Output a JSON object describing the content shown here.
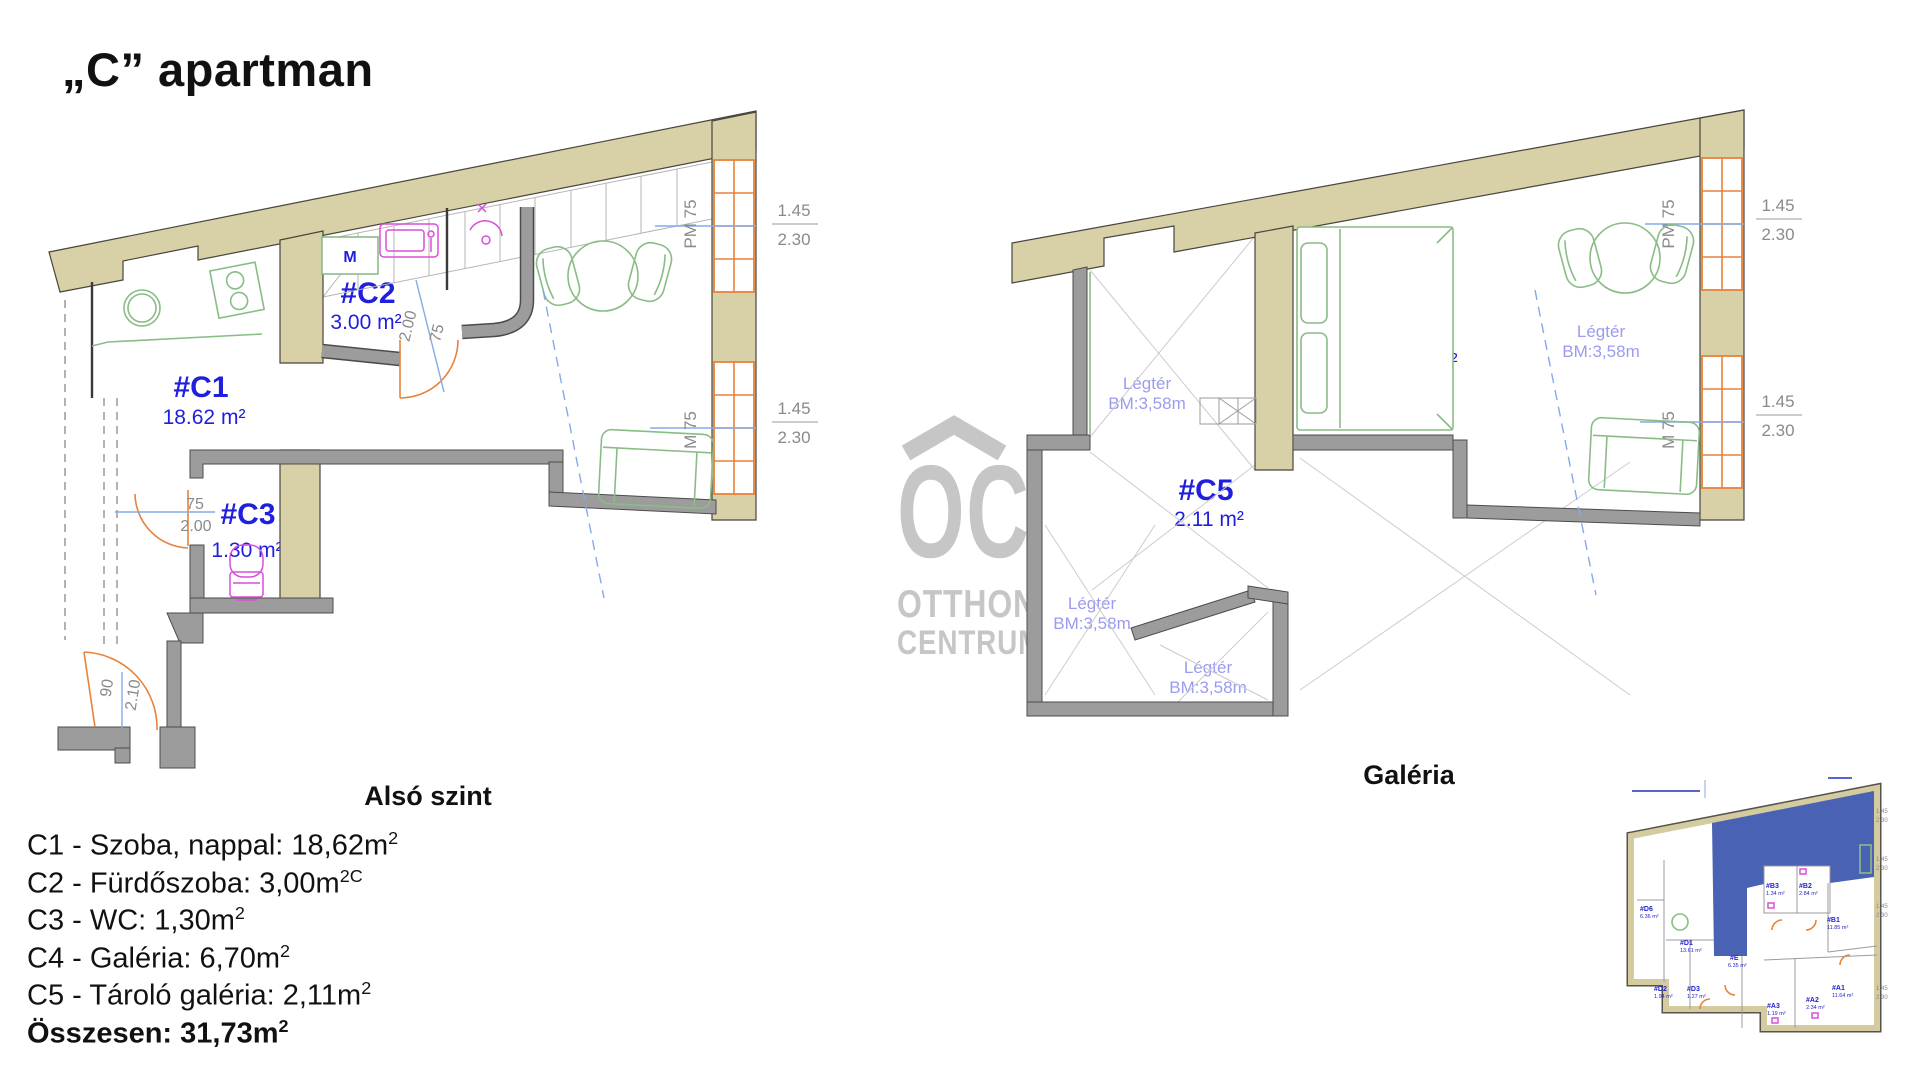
{
  "title": "„C” apartman",
  "watermark": {
    "oc": "OC",
    "otthon": "OTTHON",
    "centrum": "CENTRUM"
  },
  "lower_plan": {
    "caption": "Alsó szint",
    "washer_label": "M",
    "rooms": {
      "c1": {
        "id": "#C1",
        "area": "18.62 m²"
      },
      "c2": {
        "id": "#C2",
        "area": "3.00 m²"
      },
      "c3": {
        "id": "#C3",
        "area": "1.30 m²"
      }
    },
    "dims": {
      "door_width": "75",
      "door_height": "2.00",
      "entry_width": "90",
      "entry_height": "2.10",
      "window_width": "1.45",
      "window_height": "2.30",
      "parapet_upper": "PM 75",
      "parapet_lower": "M 75"
    }
  },
  "gallery_plan": {
    "caption": "Galéria",
    "rooms": {
      "c4": {
        "id": "#C4",
        "area": "6.70 m²"
      },
      "c5": {
        "id": "#C5",
        "area": "2.11 m²"
      }
    },
    "airspace": {
      "name": "Légtér",
      "height": "BM:3,58m"
    },
    "dims": {
      "window_width": "1.45",
      "window_height": "2.30",
      "parapet_upper": "PM 75",
      "parapet_lower": "M 75"
    }
  },
  "legend": {
    "items": [
      {
        "text": "C1 - Szoba, nappal: 18,62m",
        "sup": "2"
      },
      {
        "text": "C2 - Fürdőszoba: 3,00m",
        "sup": "2C"
      },
      {
        "text": "C3 - WC: 1,30m",
        "sup": "2"
      },
      {
        "text": "C4 - Galéria: 6,70m",
        "sup": "2"
      },
      {
        "text": "C5 - Tároló galéria: 2,11m",
        "sup": "2"
      },
      {
        "text": "Összesen: 31,73m",
        "sup": "2"
      }
    ]
  },
  "mini_plan": {
    "rooms": [
      {
        "id": "#D6",
        "area": "6.36 m²"
      },
      {
        "id": "#D1",
        "area": "13.61 m²"
      },
      {
        "id": "#D2",
        "area": "1.94 m²"
      },
      {
        "id": "#D3",
        "area": "1.27 m²"
      },
      {
        "id": "#E",
        "area": "6.35 m²"
      },
      {
        "id": "#B3",
        "area": "1.34 m²"
      },
      {
        "id": "#B2",
        "area": "2.84 m²"
      },
      {
        "id": "#B1",
        "area": "11.85 m²"
      },
      {
        "id": "#A3",
        "area": "1.19 m²"
      },
      {
        "id": "#A2",
        "area": "2.34 m²"
      },
      {
        "id": "#A1",
        "area": "11.64 m²"
      }
    ],
    "dims": {
      "window_width": "1.45",
      "window_height": "2.30"
    }
  }
}
